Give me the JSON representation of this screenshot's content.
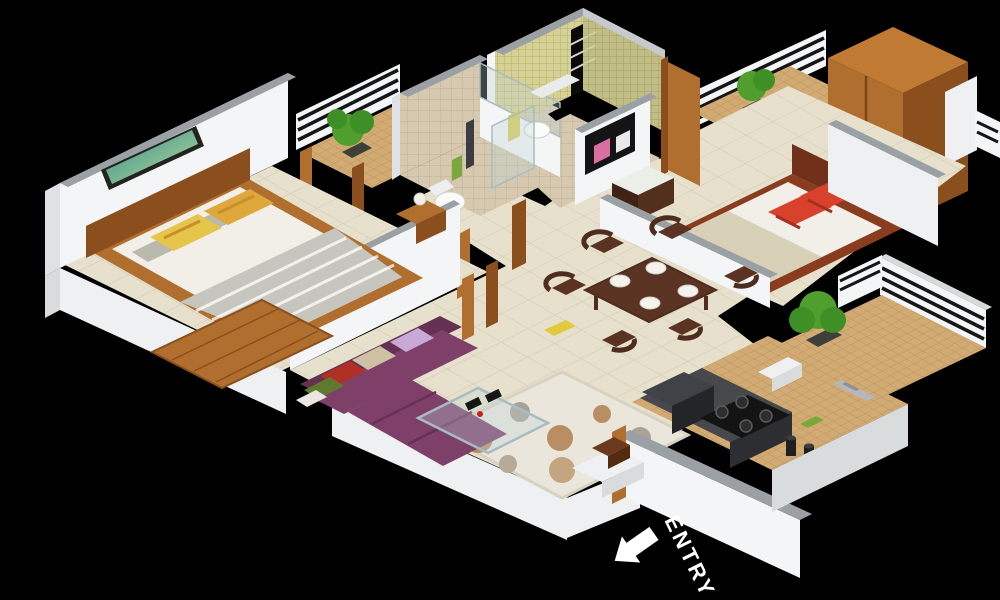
{
  "scene": {
    "description": "3D isometric floor plan render of a 2-bedroom apartment on a black background",
    "background_color": "#000000",
    "entry": {
      "label": "ENTRY",
      "color": "#ffffff",
      "icon": "arrow-up-left"
    }
  },
  "rooms": [
    {
      "id": "bedroom-1",
      "features": [
        "double-bed",
        "striped-blanket",
        "yellow-pillows",
        "wall-art",
        "bedside-table-with-lamp",
        "wooden-mat",
        "tan-rug"
      ]
    },
    {
      "id": "balcony-1",
      "features": [
        "white-railing",
        "potted-plant",
        "mosaic-floor",
        "wood-door-posts"
      ]
    },
    {
      "id": "bathroom-1",
      "features": [
        "toilet",
        "shower-panel",
        "glass-partition",
        "beige-tiled-wall",
        "towel"
      ]
    },
    {
      "id": "bathroom-2",
      "features": [
        "toilet",
        "washbasin-shelf",
        "yellow-mosaic-walls",
        "window-grill",
        "towel"
      ]
    },
    {
      "id": "bedroom-2",
      "features": [
        "double-bed",
        "red-pillows",
        "tv-panel",
        "tv-console",
        "wooden-wardrobe",
        "open-wood-door"
      ]
    },
    {
      "id": "balcony-2",
      "features": [
        "white-railing",
        "potted-plant",
        "mosaic-floor"
      ]
    },
    {
      "id": "dining-area",
      "features": [
        "dark-wood-table",
        "six-chairs",
        "four-plates",
        "low-partition-wall"
      ]
    },
    {
      "id": "living-room",
      "features": [
        "purple-l-shaped-sofa",
        "five-cushions",
        "glass-coffee-table",
        "circle-pattern-rug"
      ]
    },
    {
      "id": "kitchen",
      "features": [
        "dark-counter",
        "gas-stove-4-burner",
        "dark-appliance",
        "steel-double-sink",
        "jars",
        "wood-door-post"
      ]
    },
    {
      "id": "utility-balcony",
      "features": [
        "slatted-railing",
        "potted-plant",
        "white-bench",
        "mosaic-floor"
      ]
    },
    {
      "id": "entry",
      "features": [
        "white-step",
        "shoe-bench",
        "arrow-marker"
      ]
    }
  ],
  "palette": {
    "background": "#000000",
    "wall": "#f3f5f6",
    "wallShade": "#dfe2e4",
    "wallCap": "#9aa0a3",
    "plinth": "#eef0f1",
    "plinthShade": "#d9dcdd",
    "floorCream": "#e7e0cc",
    "floorLine": "#d5cdb6",
    "floorTan": "#d2ab74",
    "floorTanLine": "#ba9157",
    "mosaic": "#d6d295",
    "mosaicLine": "#b4ae68",
    "beigeTile": "#d6c9af",
    "beigeTileLine": "#c0b193",
    "wood": "#b06f2e",
    "woodLight": "#c07a33",
    "woodDark": "#8a4f1c",
    "woodDeep": "#6b3a1e",
    "mahogany": "#8a3c1f",
    "mahoganyDark": "#70301a",
    "mattress": "#f2efe8",
    "blanketGray": "#c6c6be",
    "blanketBeige": "#d9d0b8",
    "pillowYellow": "#e6c64a",
    "pillowOrange": "#dfa83c",
    "pillowGray": "#b9b9ae",
    "red": "#d8412b",
    "sofa": "#7e4069",
    "sofaDark": "#653153",
    "lavender": "#c9a9d6",
    "cushionBeige": "#cfc2a4",
    "cushionGreen": "#5f7a2e",
    "plant": "#4f9e2e",
    "plantDark": "#3e8f26",
    "pot": "#3c4038",
    "counter": "#46484c",
    "counterDark": "#2c2e31",
    "applianceBlack": "#141414",
    "steel": "#b4b8ba",
    "steelDark": "#8e9294",
    "rug": "#eae6dc",
    "rugEdge": "#d8d2c2",
    "rugCircle": "#b98e63",
    "rugCircleGray": "#a9a296",
    "tableWood": "#5a3323",
    "tableWoodDark": "#4e2c1e",
    "glass": "rgba(190,210,215,0.32)",
    "glassEdge": "#a9bcc0",
    "teal": "#2e8f86",
    "tealLight": "#bfd9a0",
    "frameDark": "#23231f",
    "white": "#ffffff",
    "pink": "#d86fa0"
  }
}
